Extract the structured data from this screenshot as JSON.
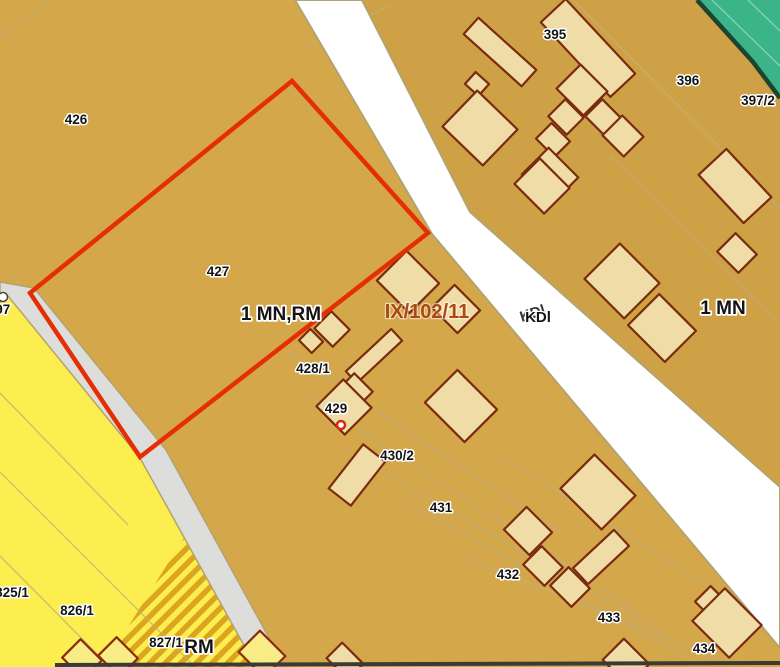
{
  "labels": {
    "parcels": {
      "p426": "426",
      "p427": "427",
      "p428_1": "428/1",
      "p429": "429",
      "p430_2": "430/2",
      "p431": "431",
      "p432": "432",
      "p433": "433",
      "p434": "434",
      "p395": "395",
      "p396": "396",
      "p397_2": "397/2",
      "p825_1": "825/1",
      "p826_1": "826/1",
      "p827_1": "827/1",
      "p897": "897"
    },
    "zones": {
      "mn_rm": "1 MN,RM",
      "mn": "1 MN",
      "rm": "RM",
      "road_class": "KDl"
    },
    "reference": {
      "case": "IX/102/11"
    }
  },
  "colors": {
    "parcel_fill": "#d5a74b",
    "building_fill": "#f0dca6",
    "building_stroke": "#7a2b0d",
    "highlight_parcel_stroke": "#e62e04",
    "main_road_fill": "#ffffff",
    "side_road_fill": "#dddddc",
    "road_edge": "#b3a36f",
    "yellow_zone_fill": "#fbee4e",
    "hatch_stripe": "#dca51f",
    "green_zone_fill": "#3cb489",
    "green_zone_edge": "#1c442e",
    "faint_boundary": "#bfae7c",
    "label_text": "#141414",
    "case_label_text": "#ac490d"
  },
  "icons": {
    "point_marker": "circle-marker",
    "utility_marker": "circle-marker"
  }
}
